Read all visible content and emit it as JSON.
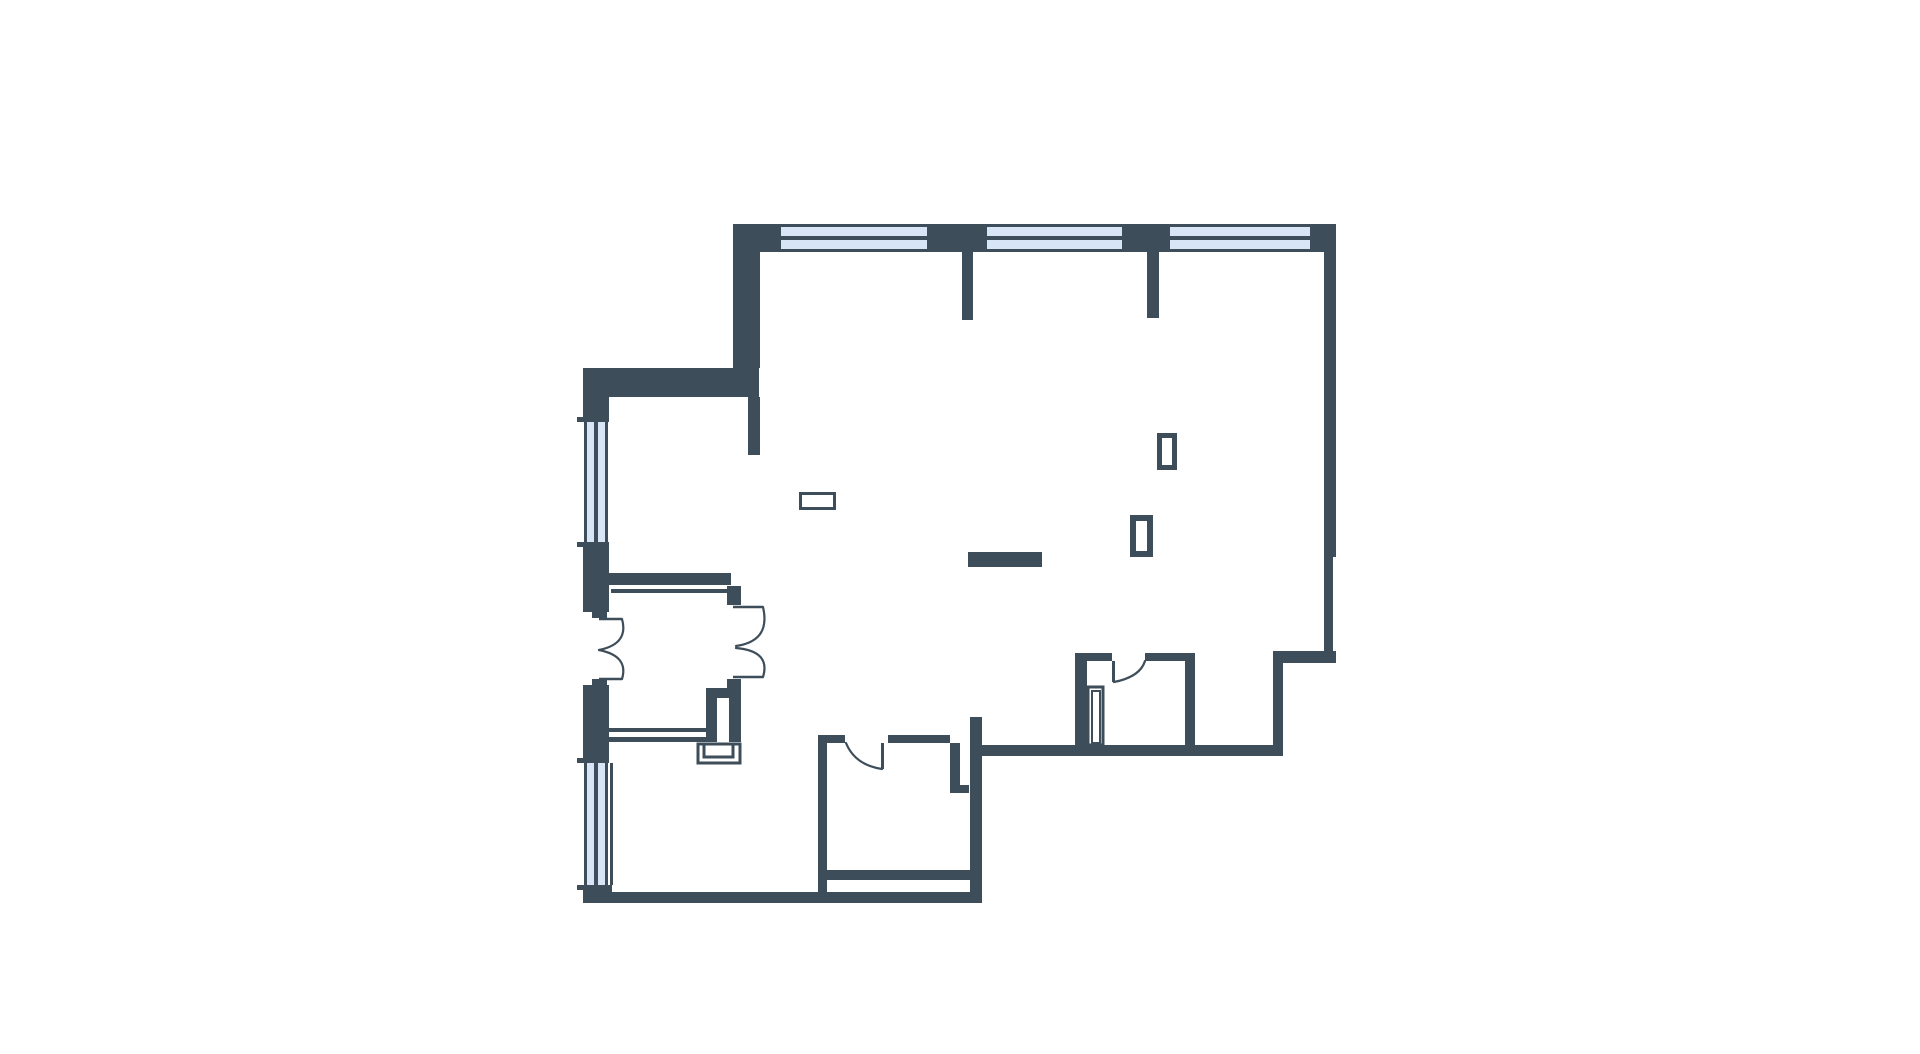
{
  "canvas": {
    "width": 1920,
    "height": 1054,
    "background": "#ffffff"
  },
  "palette": {
    "wall": "#3d4d59",
    "glass": "#d7e5f7",
    "line": "#3d4d59",
    "fixture_fill": "#ffffff"
  },
  "floor_plan": {
    "walls": [
      {
        "id": "corner-top-left",
        "x": 733,
        "y": 224,
        "w": 48,
        "h": 28
      },
      {
        "id": "pier-top-1",
        "x": 927,
        "y": 224,
        "w": 60,
        "h": 28
      },
      {
        "id": "pier-top-2",
        "x": 1122,
        "y": 224,
        "w": 48,
        "h": 28
      },
      {
        "id": "corner-top-right",
        "x": 1310,
        "y": 224,
        "w": 26,
        "h": 28
      },
      {
        "id": "wall-left-upper",
        "x": 733,
        "y": 252,
        "w": 27,
        "h": 116
      },
      {
        "id": "band-horizontal",
        "x": 583,
        "y": 368,
        "w": 176,
        "h": 29
      },
      {
        "id": "stub-below-band",
        "x": 748,
        "y": 397,
        "w": 12,
        "h": 58
      },
      {
        "id": "stub-below-pier-1",
        "x": 962,
        "y": 252,
        "w": 11,
        "h": 68
      },
      {
        "id": "stub-below-pier-2",
        "x": 1147,
        "y": 252,
        "w": 12,
        "h": 66
      },
      {
        "id": "wall-right-upper",
        "x": 1324,
        "y": 252,
        "w": 12,
        "h": 305
      },
      {
        "id": "wall-right-lower",
        "x": 1324,
        "y": 557,
        "w": 9,
        "h": 106
      },
      {
        "id": "wall-jog-right",
        "x": 1273,
        "y": 651,
        "w": 63,
        "h": 12
      },
      {
        "id": "wall-alcove-right",
        "x": 1273,
        "y": 663,
        "w": 10,
        "h": 93
      },
      {
        "id": "wall-bottom-right",
        "x": 970,
        "y": 745,
        "w": 313,
        "h": 11
      },
      {
        "id": "bath-top-left",
        "x": 1075,
        "y": 653,
        "w": 37,
        "h": 8
      },
      {
        "id": "bath-top-right",
        "x": 1145,
        "y": 653,
        "w": 50,
        "h": 8
      },
      {
        "id": "bath-wall-left",
        "x": 1075,
        "y": 653,
        "w": 12,
        "h": 92
      },
      {
        "id": "bath-wall-right",
        "x": 1185,
        "y": 653,
        "w": 10,
        "h": 92
      },
      {
        "id": "wall-left-a",
        "x": 583,
        "y": 368,
        "w": 26,
        "h": 54
      },
      {
        "id": "wall-left-b",
        "x": 583,
        "y": 542,
        "w": 26,
        "h": 70
      },
      {
        "id": "entry-jamb-top",
        "x": 592,
        "y": 612,
        "w": 15,
        "h": 6
      },
      {
        "id": "entry-jamb-bottom",
        "x": 592,
        "y": 679,
        "w": 15,
        "h": 6
      },
      {
        "id": "wall-left-c",
        "x": 583,
        "y": 685,
        "w": 26,
        "h": 78
      },
      {
        "id": "corner-bottom-left",
        "x": 583,
        "y": 885,
        "w": 29,
        "h": 18
      },
      {
        "id": "wall-bottom-left",
        "x": 583,
        "y": 892,
        "w": 399,
        "h": 11
      },
      {
        "id": "room-wall-left",
        "x": 818,
        "y": 735,
        "w": 9,
        "h": 157
      },
      {
        "id": "room-top-a",
        "x": 818,
        "y": 735,
        "w": 27,
        "h": 8
      },
      {
        "id": "room-top-b",
        "x": 888,
        "y": 735,
        "w": 62,
        "h": 8
      },
      {
        "id": "thick-stub-vertical",
        "x": 970,
        "y": 717,
        "w": 12,
        "h": 185
      },
      {
        "id": "room-inner-sill",
        "x": 827,
        "y": 870,
        "w": 143,
        "h": 10
      },
      {
        "id": "hall-top-wall",
        "x": 609,
        "y": 573,
        "w": 122,
        "h": 12
      },
      {
        "id": "hall-jamb-top",
        "x": 727,
        "y": 586,
        "w": 14,
        "h": 19
      },
      {
        "id": "hall-jamb-bottom",
        "x": 727,
        "y": 679,
        "w": 14,
        "h": 16
      },
      {
        "id": "hall-bottom-a",
        "x": 609,
        "y": 728,
        "w": 101,
        "h": 4
      },
      {
        "id": "hall-bottom-b",
        "x": 609,
        "y": 737,
        "w": 101,
        "h": 5
      },
      {
        "id": "shaft-box-left",
        "x": 706,
        "y": 688,
        "w": 11,
        "h": 54
      },
      {
        "id": "shaft-box-top",
        "x": 706,
        "y": 688,
        "w": 34,
        "h": 10
      },
      {
        "id": "shaft-box-right",
        "x": 729,
        "y": 688,
        "w": 12,
        "h": 54
      },
      {
        "id": "niche-partition-vert",
        "x": 950,
        "y": 743,
        "w": 10,
        "h": 50
      },
      {
        "id": "niche-partition-horz",
        "x": 960,
        "y": 785,
        "w": 9,
        "h": 8
      },
      {
        "id": "island-bar",
        "x": 968,
        "y": 552,
        "w": 74,
        "h": 15
      },
      {
        "id": "window-cap-1",
        "x": 577,
        "y": 417,
        "w": 8,
        "h": 5
      },
      {
        "id": "window-cap-2",
        "x": 577,
        "y": 542,
        "w": 8,
        "h": 5
      },
      {
        "id": "window-cap-3",
        "x": 577,
        "y": 758,
        "w": 8,
        "h": 5
      },
      {
        "id": "window-cap-4",
        "x": 577,
        "y": 885,
        "w": 8,
        "h": 5
      }
    ],
    "windows": [
      {
        "id": "window-top-1",
        "o": "h",
        "x": 781,
        "y": 224,
        "w": 146,
        "h": 28
      },
      {
        "id": "window-top-2",
        "o": "h",
        "x": 987,
        "y": 224,
        "w": 135,
        "h": 28
      },
      {
        "id": "window-top-3",
        "o": "h",
        "x": 1170,
        "y": 224,
        "w": 140,
        "h": 28
      },
      {
        "id": "window-left-1",
        "o": "v",
        "x": 584,
        "y": 422,
        "w": 24,
        "h": 120
      },
      {
        "id": "window-left-2",
        "o": "v",
        "x": 584,
        "y": 763,
        "w": 24,
        "h": 122
      }
    ],
    "window_frame": {
      "frame": 3,
      "mullion": 4
    },
    "thin_lines": [
      {
        "id": "hall-top-inner-line",
        "x": 611,
        "y": 589,
        "w": 130,
        "h": 4
      },
      {
        "id": "window-inner-face-line",
        "x": 610,
        "y": 763,
        "w": 3,
        "h": 122
      },
      {
        "id": "bath-door-leaf",
        "x": 1112,
        "y": 661,
        "w": 3,
        "h": 21
      },
      {
        "id": "room-door-leaf",
        "x": 881,
        "y": 743,
        "w": 3,
        "h": 26
      }
    ],
    "fixtures": [
      {
        "id": "bath-shaft-outer",
        "x": 1088,
        "y": 687,
        "w": 15,
        "h": 58,
        "sw": 3
      },
      {
        "id": "bath-shaft-inner",
        "x": 1092,
        "y": 691,
        "w": 8,
        "h": 52,
        "sw": 2
      },
      {
        "id": "panel-outer",
        "x": 698,
        "y": 744,
        "w": 42,
        "h": 19,
        "sw": 3
      },
      {
        "id": "panel-inner",
        "x": 704,
        "y": 744,
        "w": 29,
        "h": 13,
        "sw": 3
      }
    ],
    "outlets": [
      {
        "id": "outlet-left",
        "x": 799,
        "y": 492,
        "w": 37,
        "h": 18,
        "sw": 3
      },
      {
        "id": "outlet-mid",
        "x": 1130,
        "y": 515,
        "w": 23,
        "h": 42,
        "sw": 6
      },
      {
        "id": "outlet-upper",
        "x": 1157,
        "y": 433,
        "w": 20,
        "h": 37,
        "sw": 5
      }
    ],
    "door_leaves": [
      {
        "id": "entry-leaf-top",
        "d": "M 599 619 H 622"
      },
      {
        "id": "entry-leaf-bottom",
        "d": "M 599 679 H 622"
      },
      {
        "id": "hall-leaf-top",
        "d": "M 733 607 H 763"
      },
      {
        "id": "hall-leaf-bottom",
        "d": "M 733 677 H 763"
      }
    ],
    "door_arcs": [
      {
        "id": "entry-arc-top",
        "d": "M 622 619 Q 629 644 599 650"
      },
      {
        "id": "entry-arc-bottom",
        "d": "M 622 679 Q 629 656 599 650"
      },
      {
        "id": "hall-arc-top",
        "d": "M 763 607 Q 771 641 736 646"
      },
      {
        "id": "hall-arc-bottom",
        "d": "M 763 677 Q 771 651 736 648"
      },
      {
        "id": "bath-door-arc",
        "d": "M 1114 682 Q 1140 677 1145 661"
      },
      {
        "id": "room-door-arc",
        "d": "M 882 769 Q 855 765 846 743"
      }
    ]
  }
}
